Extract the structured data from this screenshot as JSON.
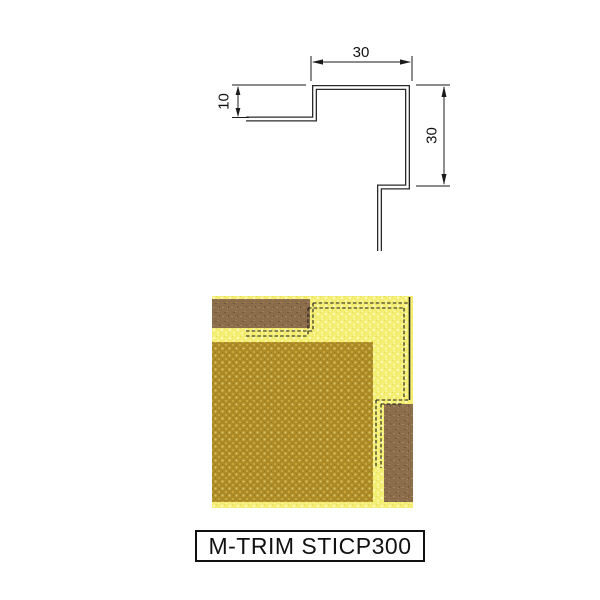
{
  "label": {
    "text": "M-TRIM STICP300"
  },
  "drawing": {
    "dim_top_value": "30",
    "dim_left_value": "10",
    "dim_right_value": "30"
  },
  "colors": {
    "line_black": "#1a1a1a",
    "bg_yellow": "#f4ee74",
    "panel_mustard": "#ad8b26",
    "panel_brown": "#8b6c4b"
  },
  "illustration": {
    "bg_texture": "speckled-yellow",
    "panels": [
      {
        "name": "top-left-panel",
        "texture": "brown-speckle"
      },
      {
        "name": "main-panel",
        "texture": "mustard-dots"
      },
      {
        "name": "bottom-right-panel",
        "texture": "brown-speckle"
      }
    ],
    "trim_outline": "dashed-hidden-edges"
  }
}
